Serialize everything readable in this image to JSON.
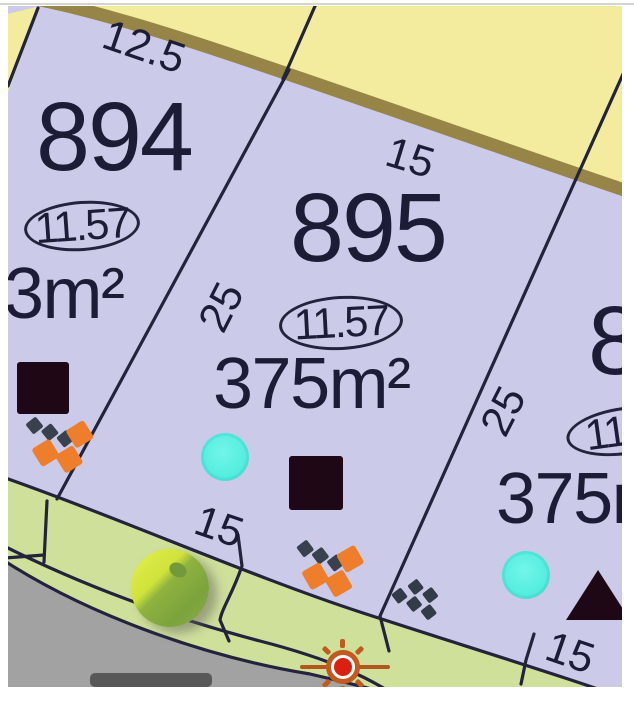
{
  "lots": {
    "lot_894": {
      "number": "894",
      "frontage_label": "11.57",
      "area_label": "3m²"
    },
    "lot_895": {
      "number": "895",
      "frontage_label": "11.57",
      "area_label": "375m²"
    },
    "lot_right": {
      "number": "8",
      "frontage_label": "11.",
      "area_label": "375m"
    }
  },
  "dimensions": {
    "top_left": "12.5",
    "top_895": "15",
    "side_894_895": "25",
    "side_895_right": "25",
    "front_894": "15",
    "front_right": "15"
  },
  "icons": {
    "dark_square": "dark-square-marker",
    "dark_triangle": "dark-triangle-marker",
    "cyan_dot": "cyan-dot-marker",
    "retaining_wall": "retaining-wall-icon",
    "steps": "steps-icon",
    "sun": "sun-icon",
    "tree": "tree-icon"
  },
  "colors": {
    "lot_fill": "#cbcbe9",
    "neighbor_fill": "#f3ec9e",
    "edge_band": "#968547",
    "verge": "#cfe09b",
    "road": "#a2a2a2",
    "boundary": "#23233c",
    "text": "#1c1c36",
    "cyan": "#58eee0",
    "orange": "#ee7d2c",
    "dark_marker": "#1f0816",
    "sun_red": "#da2110",
    "ball_light": "#cfe23c",
    "ball_dark": "#7ba33c"
  }
}
